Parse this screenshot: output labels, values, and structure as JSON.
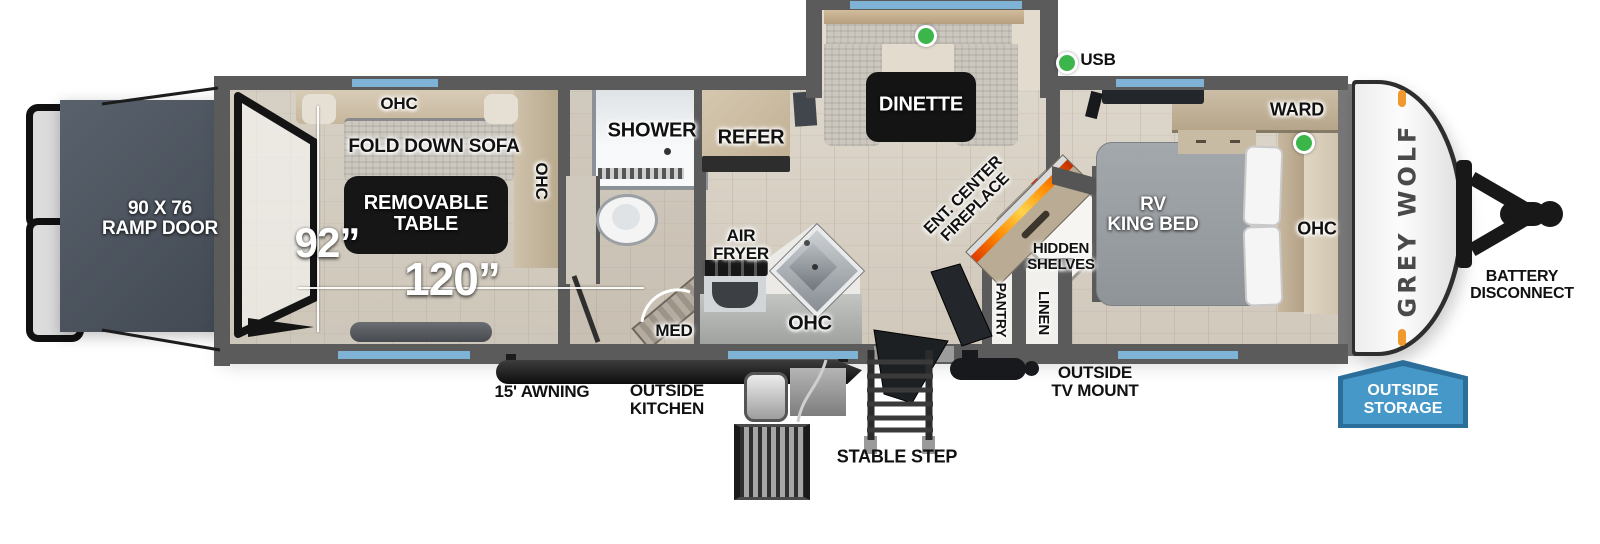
{
  "colors": {
    "window_blue": "#7fb3d5",
    "marker_green": "#3cb54a",
    "storage_badge_blue": "#4598c8",
    "storage_badge_border": "#2b6e9a",
    "fireplace_flame_orange": "#ff8a00",
    "wall_gray": "#5b5b5b",
    "clearance_light_orange": "#f2992e"
  },
  "markers": {
    "usb_legend": "USB"
  },
  "rear": {
    "ramp_door": "90 X 76\nRAMP DOOR"
  },
  "garage": {
    "ohc_top": "OHC",
    "fold_down_sofa": "FOLD DOWN SOFA",
    "removable_table": "REMOVABLE\nTABLE",
    "ohc_right": "OHC",
    "width": "92”",
    "length": "120”"
  },
  "bathroom": {
    "shower": "SHOWER",
    "med": "MED"
  },
  "kitchen": {
    "refer": "REFER",
    "air_fryer": "AIR\nFRYER",
    "ohc": "OHC"
  },
  "dinette": {
    "label": "DINETTE"
  },
  "living": {
    "ent_center_fireplace": "ENT. CENTER\nFIREPLACE",
    "hidden_shelves": "HIDDEN\nSHELVES",
    "pantry": "PANTRY",
    "linen": "LINEN"
  },
  "bedroom": {
    "rv_king_bed": "RV\nKING BED",
    "ward": "WARD",
    "ohc": "OHC"
  },
  "front": {
    "brand_logo": "GREY WOLF",
    "battery_disconnect": "BATTERY\nDISCONNECT"
  },
  "exterior": {
    "awning": "15' AWNING",
    "outside_kitchen": "OUTSIDE\nKITCHEN",
    "stable_step": "STABLE STEP",
    "outside_tv_mount": "OUTSIDE\nTV MOUNT",
    "outside_storage": "OUTSIDE\nSTORAGE"
  }
}
